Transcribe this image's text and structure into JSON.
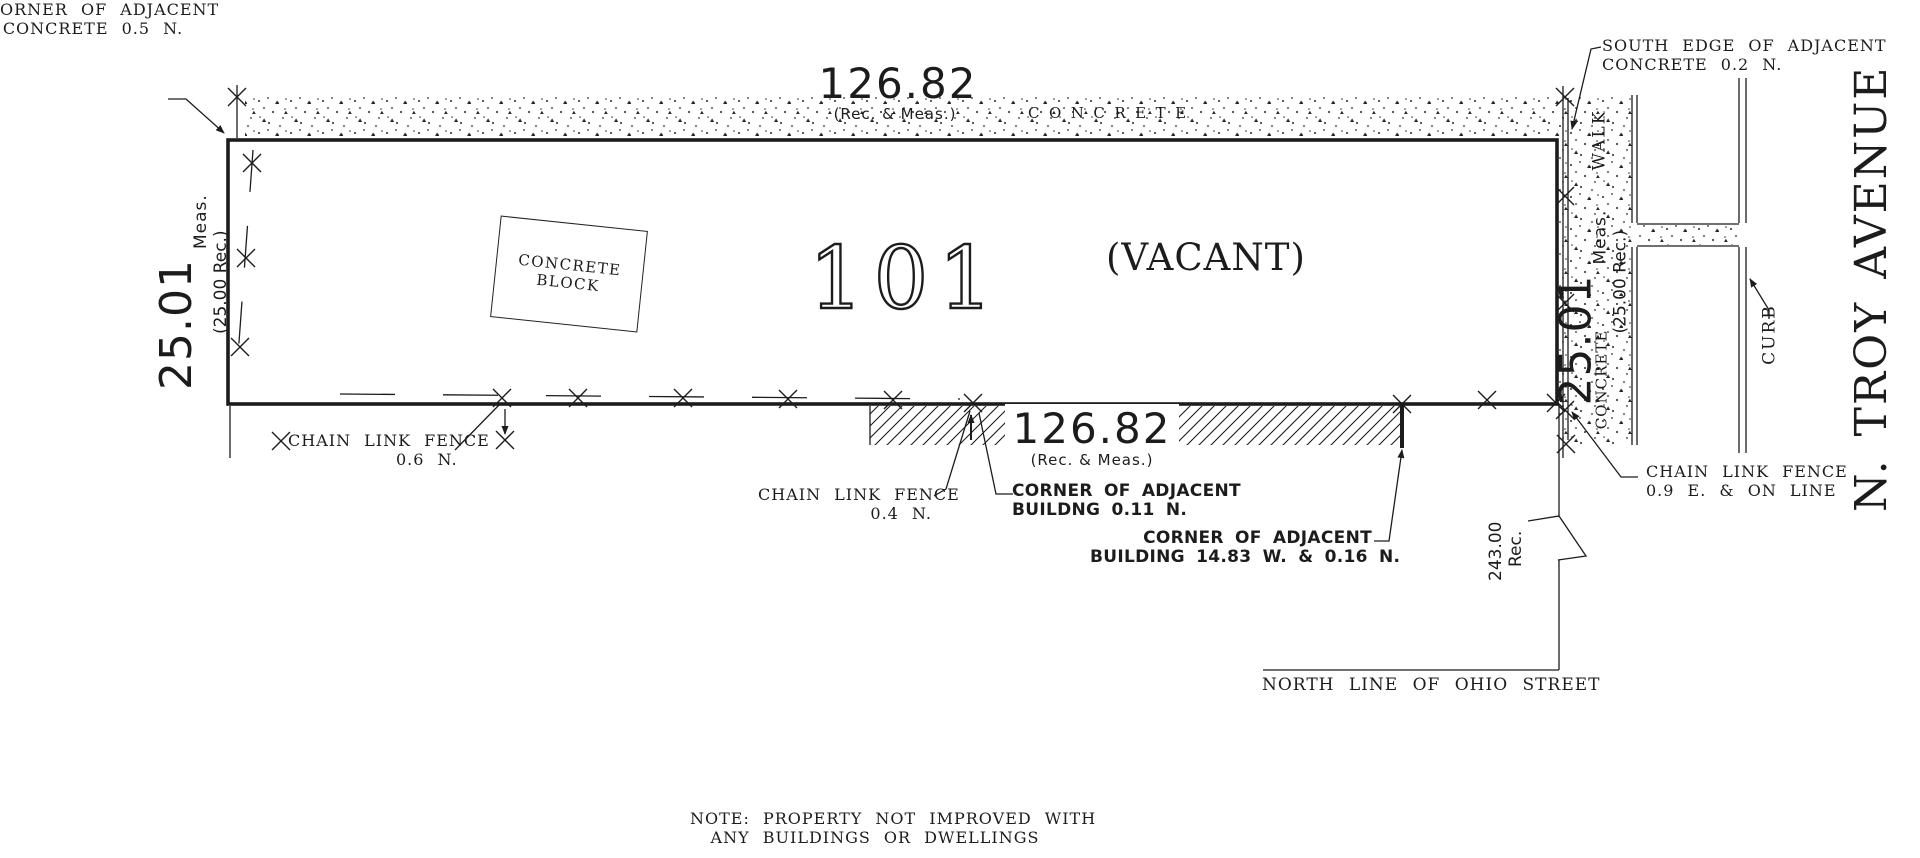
{
  "ink": "#1c1c1c",
  "parcel": {
    "number": "101",
    "status": "(VACANT)"
  },
  "dimensions": {
    "north": {
      "value": "126.82",
      "note": "(Rec. & Meas.)"
    },
    "south": {
      "value": "126.82",
      "note": "(Rec. & Meas.)"
    },
    "west": {
      "value": "25.01",
      "meas": "Meas.",
      "rec": "(25.00 Rec.)"
    },
    "east": {
      "value": "25.01",
      "meas": "Meas.",
      "rec": "(25.00 Rec.)"
    },
    "ohio_frontage": {
      "value": "243.00",
      "note": "Rec."
    }
  },
  "surfaces": {
    "north_concrete": "CONCRETE",
    "block_line1": "CONCRETE",
    "block_line2": "BLOCK",
    "walk": "WALK",
    "walk_material": "CONCRETE",
    "curb": "CURB"
  },
  "street": {
    "name": "N. TROY AVENUE",
    "south_line": "NORTH LINE OF OHIO STREET"
  },
  "annotations": {
    "nw": {
      "line1": "ORNER OF ADJACENT",
      "line2": "CONCRETE 0.5 N."
    },
    "ne": {
      "line1": "SOUTH EDGE OF ADJACENT",
      "line2": "CONCRETE 0.2 N."
    },
    "fence_west": {
      "line1": "CHAIN LINK FENCE",
      "line2": "0.6 N."
    },
    "fence_south": {
      "line1": "CHAIN LINK FENCE",
      "line2": "0.4 N."
    },
    "fence_east": {
      "line1": "CHAIN LINK FENCE",
      "line2": "0.9 E. & ON LINE"
    },
    "building1": {
      "line1": "CORNER OF ADJACENT",
      "line2": "BUILDNG 0.11 N."
    },
    "building2": {
      "line1": "CORNER OF ADJACENT",
      "line2": "BUILDING 14.83 W. & 0.16 N."
    }
  },
  "note": {
    "line1": "NOTE: PROPERTY NOT IMPROVED WITH",
    "line2": "ANY BUILDINGS OR DWELLINGS"
  }
}
